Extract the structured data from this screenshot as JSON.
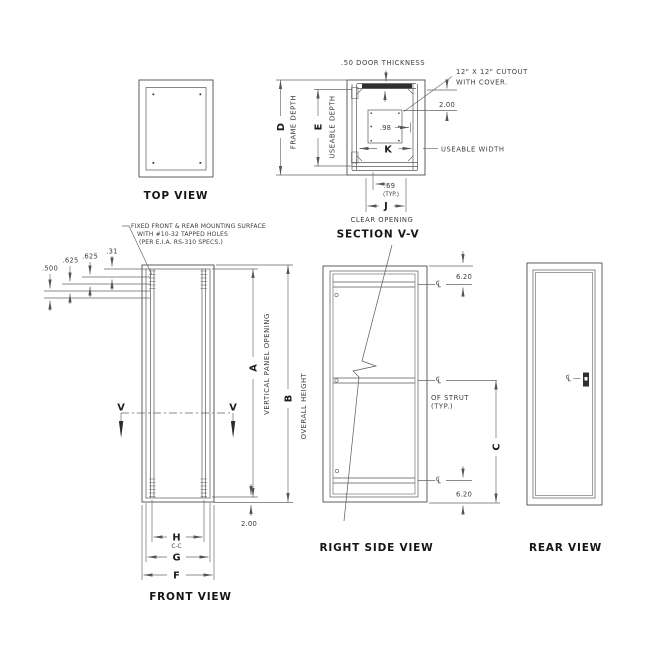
{
  "colors": {
    "object_line": "#4e4e4e",
    "dim_line": "#666666",
    "dim_text": "#3d3d3d",
    "label_text": "#161616",
    "background": "#ffffff"
  },
  "icons": {
    "centerline_symbol": "℄",
    "arrowhead": "filled-triangle"
  },
  "views": {
    "top": {
      "title": "TOP VIEW"
    },
    "section": {
      "title": "SECTION V-V",
      "door_thickness": ".50 DOOR THICKNESS",
      "cutout_l1": "12\" X 12\" CUTOUT",
      "cutout_l2": "WITH COVER.",
      "dim_door_to_cutout": "2.00",
      "dim_hole": ".98",
      "k": "K",
      "useable_width": "USEABLE WIDTH",
      "dim_69": ".69",
      "dim_69_typ": "(TYP.)",
      "j": "J",
      "clear_opening": "CLEAR OPENING",
      "d": "D",
      "frame_depth": "FRAME DEPTH",
      "e": "E",
      "useable_depth": "USEABLE DEPTH"
    },
    "front": {
      "title": "FRONT VIEW",
      "note_l1": "FIXED FRONT & REAR MOUNTING SURFACE",
      "note_l2": "WITH #10-32 TAPPED HOLES",
      "note_l3": "(PER E.I.A. RS-310 SPECS.)",
      "dim_500": ".500",
      "dim_625a": ".625",
      "dim_625b": ".625",
      "dim_31": ".31",
      "v_left": "V",
      "v_right": "V",
      "a": "A",
      "vertical_panel_opening": "VERTICAL PANEL OPENING",
      "b": "B",
      "overall_height": "OVERALL HEIGHT",
      "dim_bottom": "2.00",
      "h": "H",
      "cc": "C-C",
      "g": "G",
      "f": "F"
    },
    "right": {
      "title": "RIGHT SIDE VIEW",
      "dim_620_top": "6.20",
      "dim_620_bottom": "6.20",
      "c": "C",
      "of_strut": "OF STRUT",
      "of_strut_typ": "(TYP.)"
    },
    "rear": {
      "title": "REAR VIEW"
    }
  }
}
